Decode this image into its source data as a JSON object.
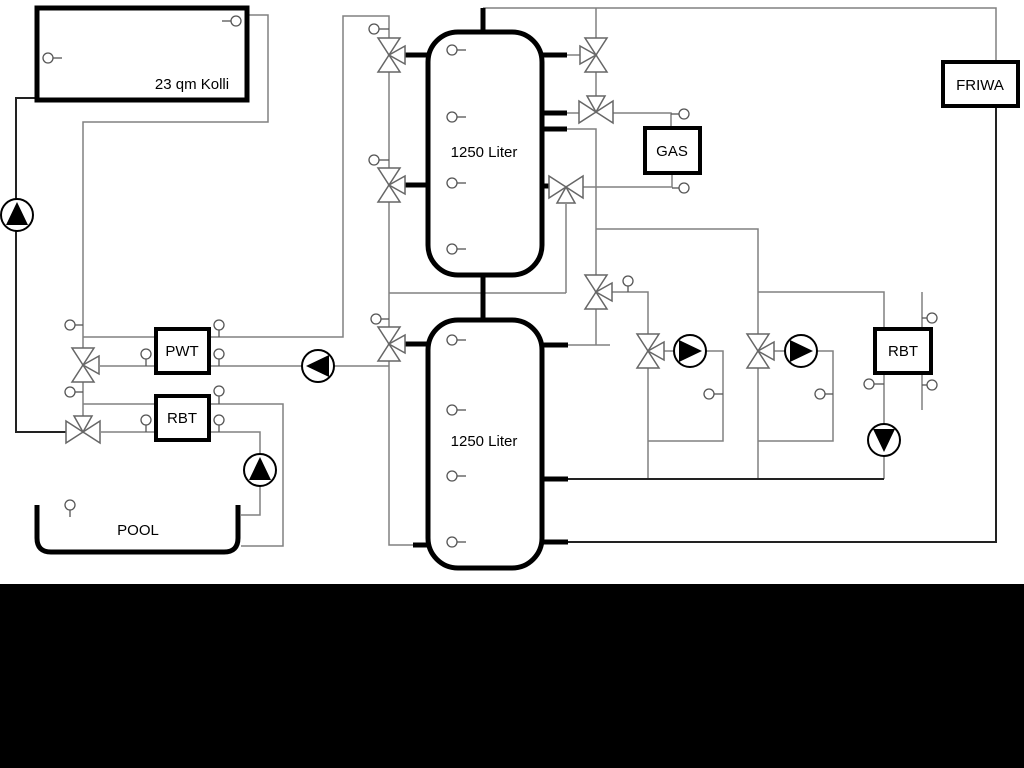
{
  "diagram": {
    "type": "hydraulic-schematic",
    "labels": {
      "collector": "23 qm Kolli",
      "upper_tank": "1250 Liter",
      "lower_tank": "1250 Liter",
      "pwt": "PWT",
      "rbt_left": "RBT",
      "gas": "GAS",
      "friwa": "FRIWA",
      "rbt_right": "RBT",
      "pool": "POOL"
    },
    "colors": {
      "pipe_thin": "#808080",
      "pipe_dark": "#222222",
      "outline": "#000000",
      "background": "#ffffff",
      "bottom_bar": "#000000"
    },
    "components": {
      "pumps": [
        {
          "name": "solar-pump",
          "direction": "up"
        },
        {
          "name": "heat-exchanger-pump",
          "direction": "left"
        },
        {
          "name": "pool-pump",
          "direction": "up"
        },
        {
          "name": "heating-circuit-1-pump",
          "direction": "right"
        },
        {
          "name": "heating-circuit-2-pump",
          "direction": "right"
        },
        {
          "name": "rbt-right-pump",
          "direction": "down"
        }
      ],
      "three_way_valves": 11,
      "temperature_sensors": 30
    }
  }
}
